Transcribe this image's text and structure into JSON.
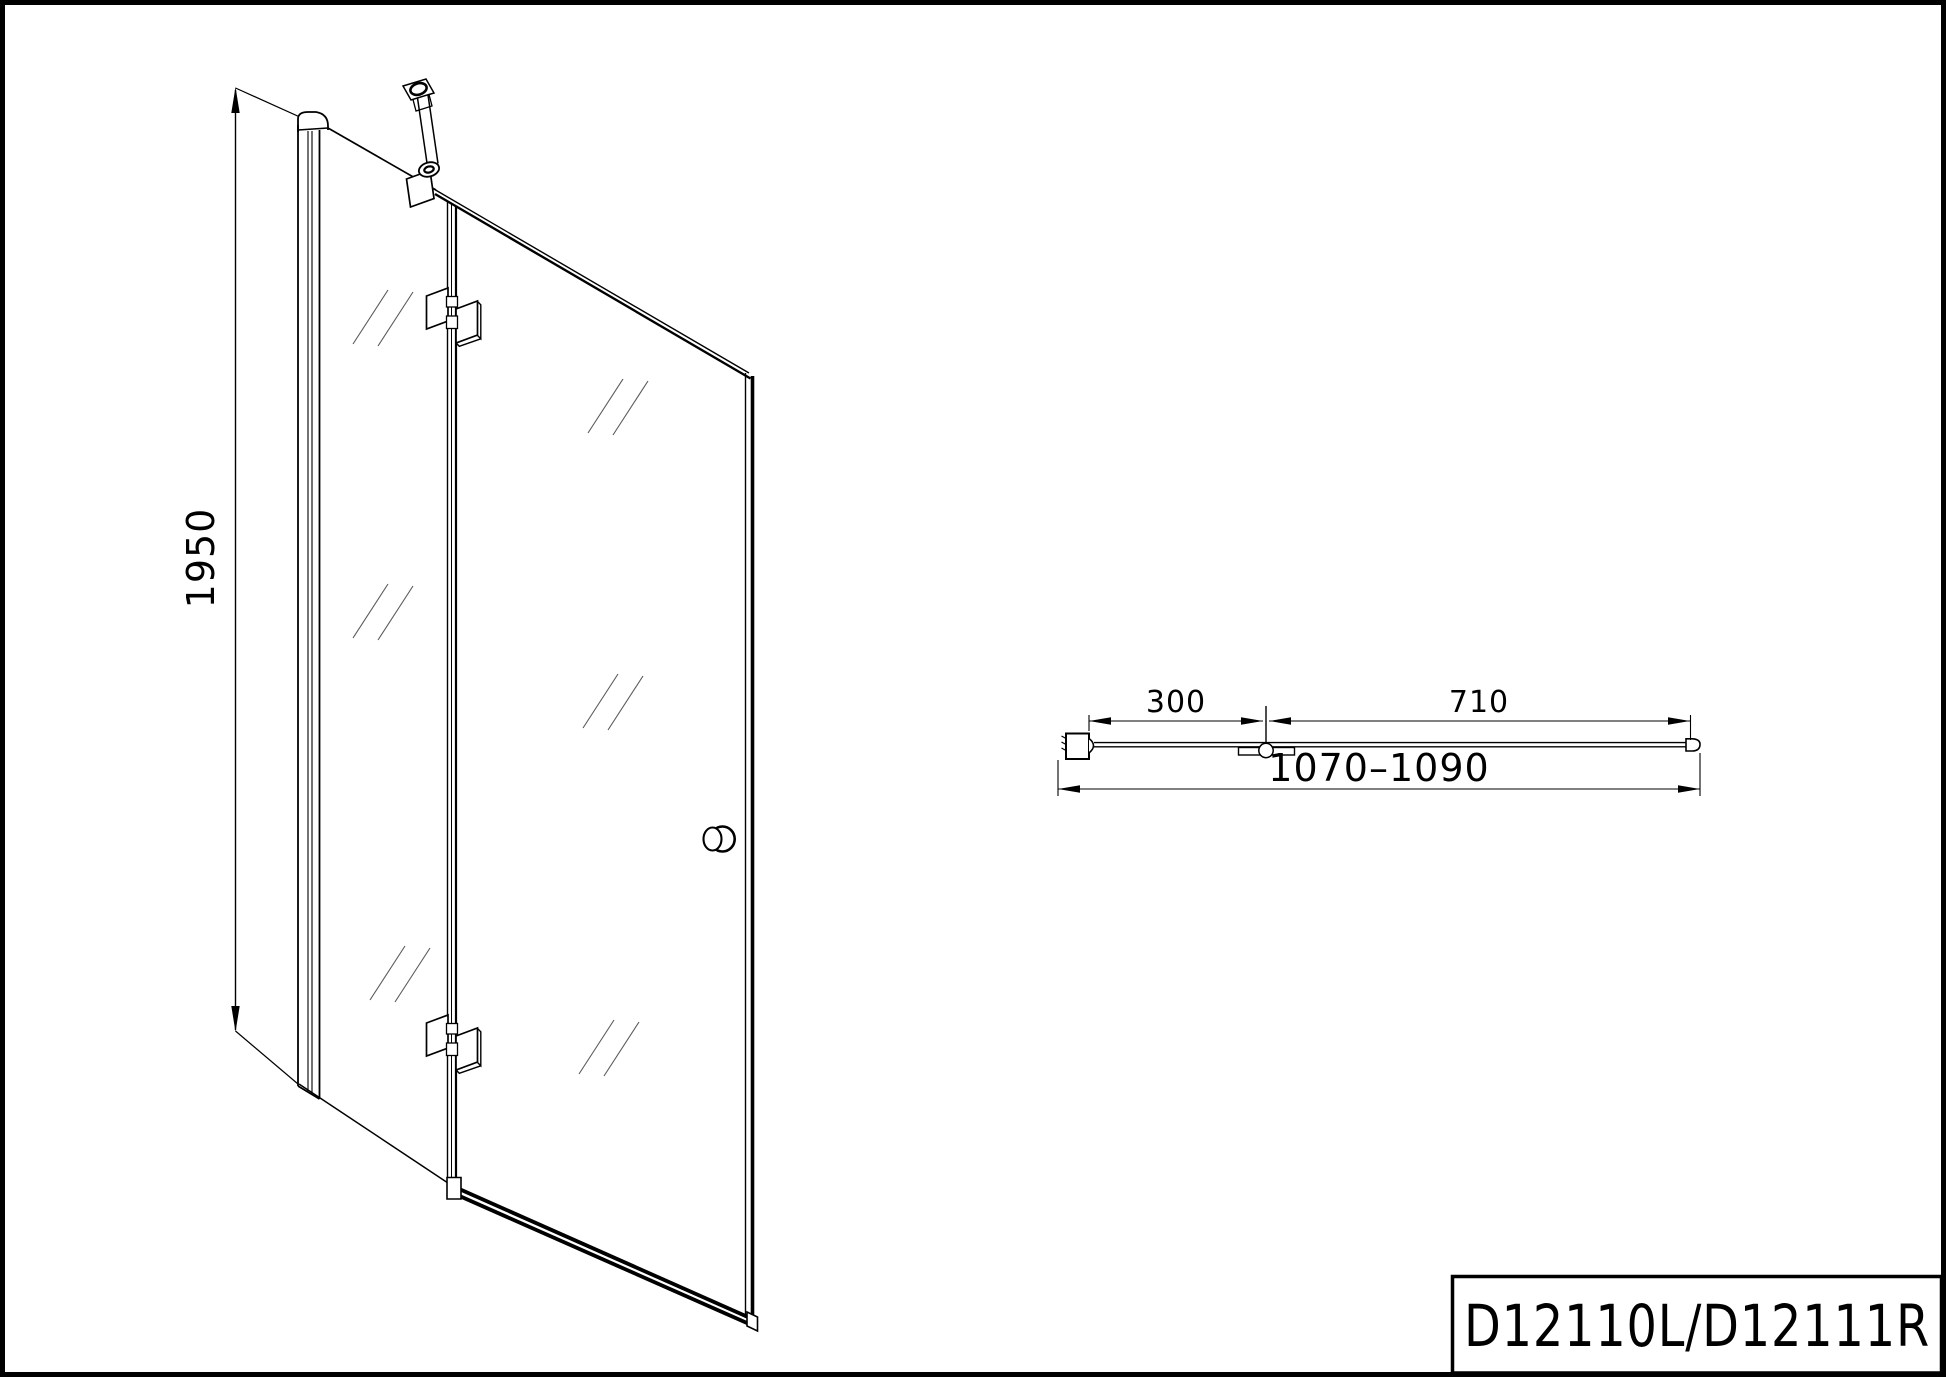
{
  "page": {
    "background": "#ffffff",
    "line_color": "#000000",
    "glass_mark_color": "#5a5a5a"
  },
  "title_block": {
    "model_code": "D12110L/D12111R"
  },
  "front_view": {
    "height_dimension": "1950"
  },
  "top_view": {
    "fixed_panel_width": "300",
    "door_panel_width": "710",
    "total_width_range": "1070–1090"
  }
}
